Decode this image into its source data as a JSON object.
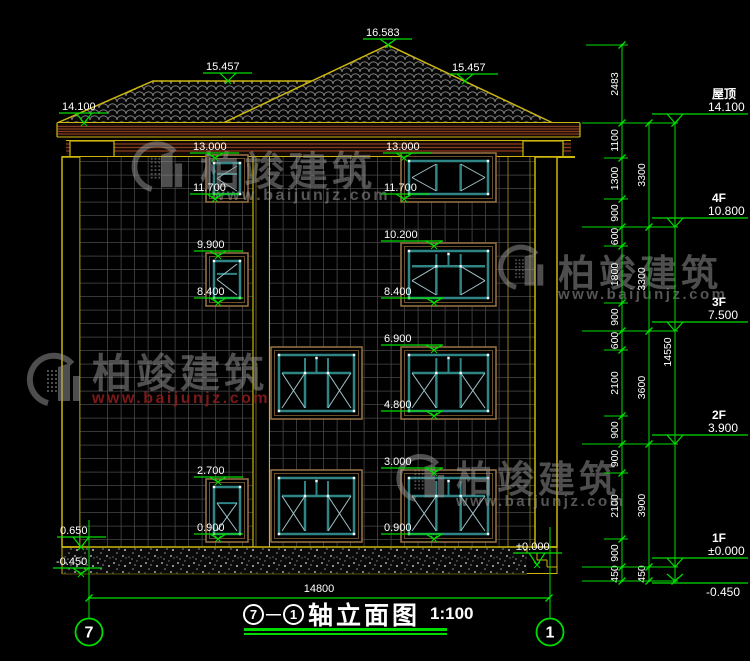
{
  "drawing": {
    "title": {
      "axis_start": "7",
      "separator": "—",
      "axis_end": "1",
      "name": "轴立面图",
      "scale": "1:100"
    },
    "watermark": {
      "brand": "柏竣建筑",
      "url": "www.baijunjz.com"
    },
    "floor_markers": [
      {
        "label": "屋顶",
        "value": "14.100",
        "y": 123
      },
      {
        "label": "4F",
        "value": "10.800",
        "y": 227
      },
      {
        "label": "3F",
        "value": "7.500",
        "y": 331
      },
      {
        "label": "2F",
        "value": "3.900",
        "y": 444
      },
      {
        "label": "1F",
        "value": "±0.000",
        "y": 567
      },
      {
        "label": "",
        "value": "-0.450",
        "y": 581,
        "below": true
      }
    ],
    "elevation_markers": [
      {
        "v": "16.583",
        "tx": 366,
        "ty": 36,
        "px": 388,
        "py": 45
      },
      {
        "v": "15.457",
        "tx": 206,
        "ty": 70,
        "px": 228,
        "py": 81
      },
      {
        "v": "15.457",
        "tx": 452,
        "ty": 71,
        "px": 465,
        "py": 81
      },
      {
        "v": "14.100",
        "tx": 62,
        "ty": 110,
        "px": 84,
        "py": 123
      },
      {
        "v": "13.000",
        "tx": 193,
        "ty": 150,
        "px": 215,
        "py": 158
      },
      {
        "v": "11.700",
        "tx": 193,
        "ty": 191,
        "px": 215,
        "py": 199
      },
      {
        "v": "9.900",
        "tx": 197,
        "ty": 248,
        "px": 218,
        "py": 256
      },
      {
        "v": "8.400",
        "tx": 197,
        "ty": 295,
        "px": 218,
        "py": 303
      },
      {
        "v": "2.700",
        "tx": 197,
        "ty": 474,
        "px": 218,
        "py": 482
      },
      {
        "v": "0.900",
        "tx": 197,
        "ty": 531,
        "px": 218,
        "py": 539
      },
      {
        "v": "13.000",
        "tx": 386,
        "ty": 150,
        "px": 404,
        "py": 158
      },
      {
        "v": "11.700",
        "tx": 384,
        "ty": 191,
        "px": 404,
        "py": 199
      },
      {
        "v": "10.200",
        "tx": 384,
        "ty": 238,
        "px": 434,
        "py": 246
      },
      {
        "v": "8.400",
        "tx": 384,
        "ty": 295,
        "px": 434,
        "py": 303
      },
      {
        "v": "6.900",
        "tx": 384,
        "ty": 342,
        "px": 434,
        "py": 350
      },
      {
        "v": "4.800",
        "tx": 384,
        "ty": 408,
        "px": 434,
        "py": 416
      },
      {
        "v": "3.000",
        "tx": 384,
        "ty": 465,
        "px": 434,
        "py": 473
      },
      {
        "v": "0.900",
        "tx": 384,
        "ty": 531,
        "px": 434,
        "py": 539
      },
      {
        "v": "0.650",
        "tx": 60,
        "ty": 534,
        "px": 81,
        "py": 547
      },
      {
        "v": "-0.450",
        "tx": 56,
        "ty": 565,
        "px": 81,
        "py": 574
      },
      {
        "v": "±0.000",
        "tx": 516,
        "ty": 550,
        "px": 537,
        "py": 565
      }
    ],
    "dim_chain_small": [
      [
        "2483",
        45,
        123
      ],
      [
        "1100",
        123,
        158
      ],
      [
        "1300",
        158,
        199
      ],
      [
        "900",
        199,
        227
      ],
      [
        "600",
        227,
        246
      ],
      [
        "1800",
        246,
        303
      ],
      [
        "900",
        303,
        331
      ],
      [
        "600",
        331,
        350
      ],
      [
        "2100",
        350,
        416
      ],
      [
        "900",
        416,
        444
      ],
      [
        "900",
        444,
        473
      ],
      [
        "2100",
        473,
        539
      ],
      [
        "900",
        539,
        567
      ],
      [
        "450",
        567,
        581
      ]
    ],
    "dim_chain_floor": [
      [
        "3300",
        123,
        227
      ],
      [
        "3300",
        227,
        331
      ],
      [
        "3600",
        331,
        444
      ],
      [
        "3900",
        444,
        567
      ],
      [
        "450",
        567,
        581
      ]
    ],
    "dim_total": [
      "14550",
      123,
      581
    ],
    "dim_bottom": {
      "v": "14800",
      "x1": 89,
      "x2": 549,
      "y": 598,
      "tx": 319,
      "ty": 592
    },
    "axes": [
      {
        "label": "7",
        "x": 89,
        "top": 520
      },
      {
        "label": "1",
        "x": 550,
        "top": 527
      }
    ],
    "windows": [
      {
        "x": 206,
        "y": 155,
        "w": 42,
        "h": 47,
        "kind": "small-v"
      },
      {
        "x": 206,
        "y": 253,
        "w": 42,
        "h": 53,
        "kind": "small-v"
      },
      {
        "x": 206,
        "y": 479,
        "w": 42,
        "h": 63,
        "kind": "small-x"
      },
      {
        "x": 401,
        "y": 153,
        "w": 95,
        "h": 49,
        "kind": "big-single"
      },
      {
        "x": 401,
        "y": 243,
        "w": 95,
        "h": 63,
        "kind": "big-transom-v"
      },
      {
        "x": 401,
        "y": 347,
        "w": 95,
        "h": 72,
        "kind": "big-transom-x"
      },
      {
        "x": 401,
        "y": 470,
        "w": 95,
        "h": 72,
        "kind": "big-transom-x"
      },
      {
        "x": 271,
        "y": 347,
        "w": 91,
        "h": 72,
        "kind": "big-transom-x"
      },
      {
        "x": 271,
        "y": 470,
        "w": 91,
        "h": 72,
        "kind": "big-transom-x"
      }
    ],
    "watermarks": [
      {
        "x": 165,
        "y": 172,
        "s": 0.95,
        "brand_x": 200,
        "brand_y": 185,
        "brand_size": 40,
        "url_x": 212,
        "url_y": 200,
        "url_size": 16,
        "url_color": "gray"
      },
      {
        "x": 528,
        "y": 272,
        "s": 0.85,
        "brand_x": 558,
        "brand_y": 286,
        "brand_size": 37,
        "url_x": 558,
        "url_y": 299,
        "url_size": 15,
        "url_color": "gray"
      },
      {
        "x": 62,
        "y": 385,
        "s": 1,
        "brand_x": 92,
        "brand_y": 387,
        "brand_size": 40,
        "url_x": 92,
        "url_y": 403,
        "url_size": 16,
        "url_color": "red"
      },
      {
        "x": 428,
        "y": 483,
        "s": 0.9,
        "brand_x": 456,
        "brand_y": 492,
        "brand_size": 37,
        "url_x": 456,
        "url_y": 506,
        "url_size": 15,
        "url_color": "gray"
      }
    ]
  },
  "colors": {
    "background": "#000000",
    "green": "#00dc00",
    "yellow": "#cdb70e",
    "dim_yellow": "#8a7c10",
    "cornice_brown": "#8a3b1d",
    "frame_brown": "#9a7446",
    "frame_brown_dark": "#6b4e2a",
    "teal": "#2f8585",
    "diag": "#9fc3c9",
    "grid": "#464646",
    "text": "#ffffff",
    "watermark_gray": "#9b9b9b",
    "watermark_red": "#8a1c1c",
    "roof_arc": "#8f8f8f"
  }
}
